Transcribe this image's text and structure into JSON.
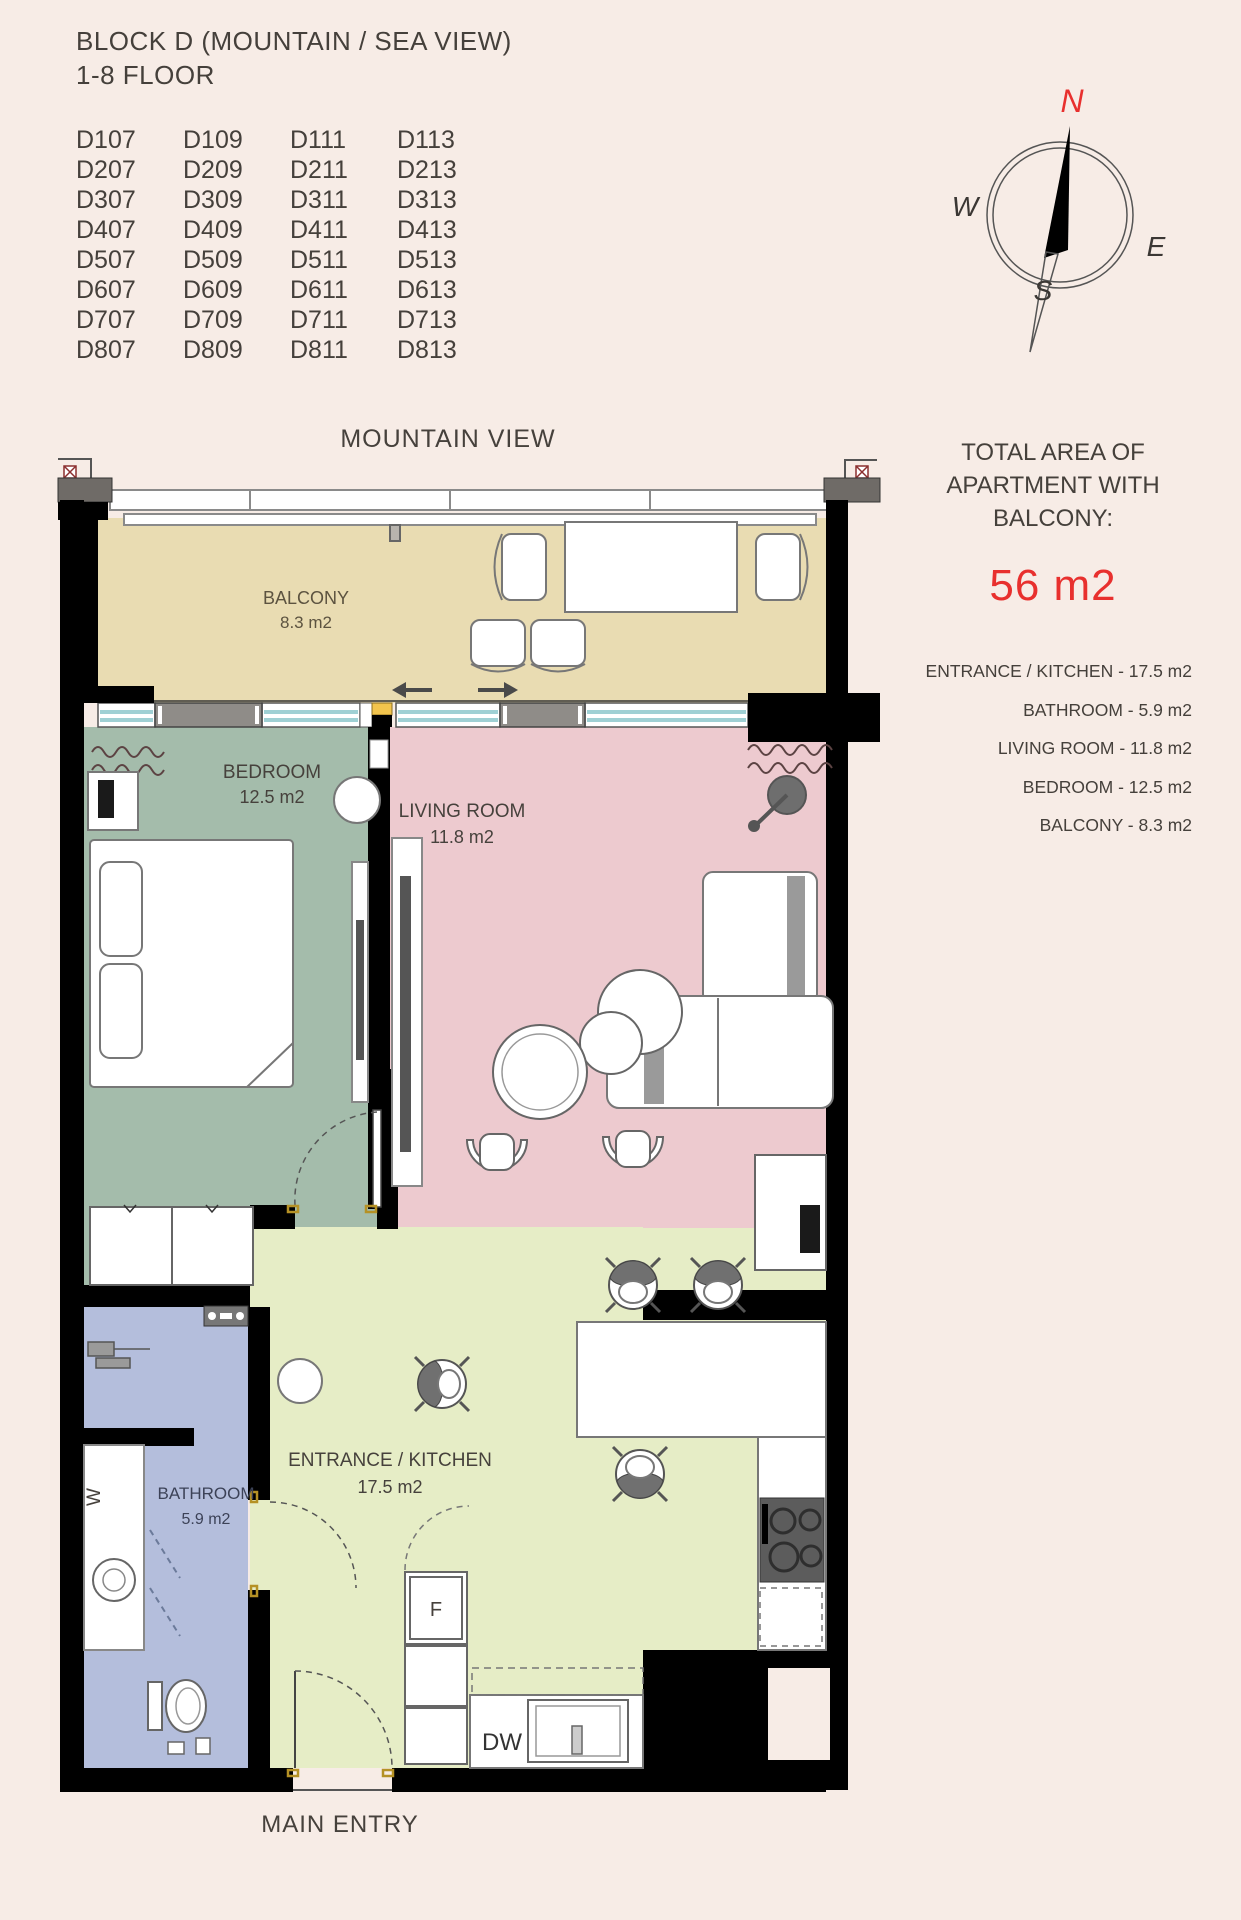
{
  "header": {
    "title": "BLOCK D (MOUNTAIN / SEA VIEW)",
    "subtitle": "1-8 FLOOR"
  },
  "units": {
    "list": [
      "D107",
      "D109",
      "D111",
      "D113",
      "D207",
      "D209",
      "D211",
      "D213",
      "D307",
      "D309",
      "D311",
      "D313",
      "D407",
      "D409",
      "D411",
      "D413",
      "D507",
      "D509",
      "D511",
      "D513",
      "D607",
      "D609",
      "D611",
      "D613",
      "D707",
      "D709",
      "D711",
      "D713",
      "D807",
      "D809",
      "D811",
      "D813"
    ]
  },
  "compass": {
    "n": "N",
    "e": "E",
    "s": "S",
    "w": "W"
  },
  "plan": {
    "view_label": "MOUNTAIN VIEW",
    "main_entry_label": "MAIN ENTRY",
    "rooms": {
      "balcony": {
        "name": "BALCONY",
        "area": "8.3 m2"
      },
      "bedroom": {
        "name": "BEDROOM",
        "area": "12.5 m2"
      },
      "living": {
        "name": "LIVING ROOM",
        "area": "11.8 m2"
      },
      "bathroom": {
        "name": "BATHROOM",
        "area": "5.9 m2"
      },
      "kitchen": {
        "name": "ENTRANCE / KITCHEN",
        "area": "17.5 m2"
      }
    },
    "appliances": {
      "fridge": "F",
      "dishwasher": "DW",
      "washer": "W"
    }
  },
  "summary": {
    "heading_line1": "TOTAL AREA OF",
    "heading_line2": "APARTMENT WITH",
    "heading_line3": "BALCONY:",
    "total": "56 m2",
    "items": [
      "ENTRANCE / KITCHEN - 17.5 m2",
      "BATHROOM - 5.9 m2",
      "LIVING ROOM - 11.8 m2",
      "BEDROOM - 12.5 m2",
      "BALCONY - 8.3 m2"
    ]
  },
  "colors": {
    "background": "#f7ece6",
    "balcony": "#e9dcb2",
    "bedroom": "#a4bcab",
    "living": "#edcacf",
    "bathroom": "#b4bedc",
    "kitchen": "#e6edc6",
    "accent_red": "#e8302e",
    "wall": "#000000"
  }
}
